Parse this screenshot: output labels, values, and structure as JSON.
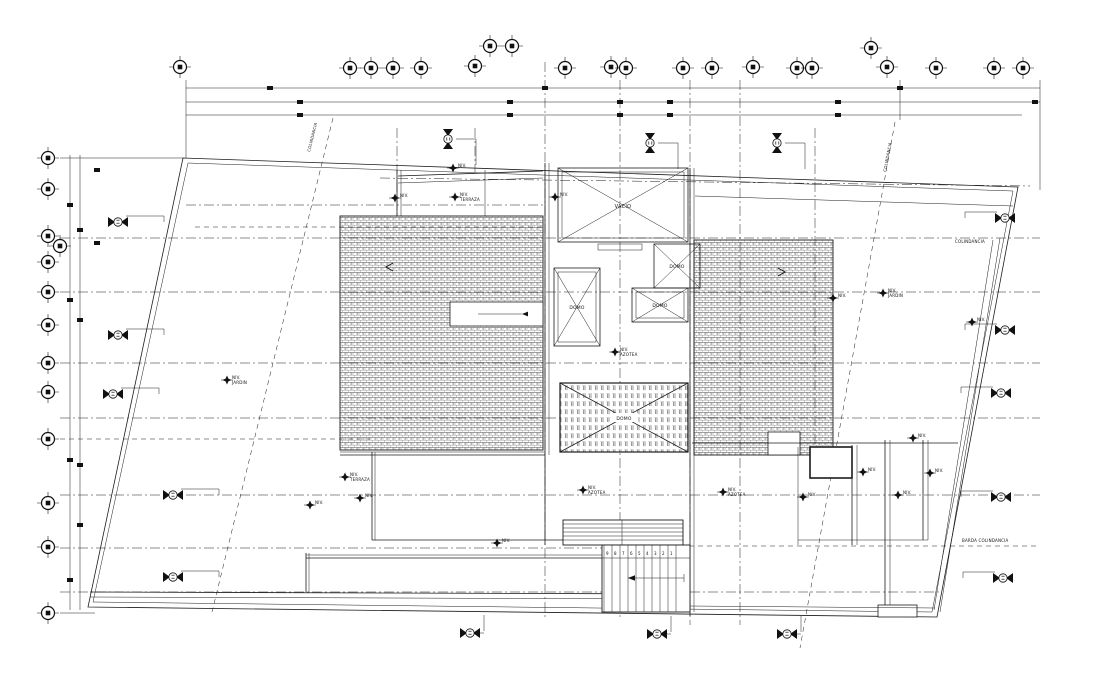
{
  "drawing": {
    "background": "#ffffff",
    "ink": "#1c1c1c",
    "type": "architectural roof plan (CAD)"
  },
  "labels": {
    "niv": "NIV.",
    "vacio": "VACIO",
    "domo": "DOMO",
    "barda_note": "BARDA COLINDANCIA",
    "colindancia_left": "COLINDANCIA",
    "colindancia_right": "COLINDANCIA",
    "corner_note": "COLINDANCIA"
  },
  "levels": [
    {
      "name": "TERRAZA"
    },
    {
      "name": "JARDIN"
    },
    {
      "name": "TERRAZA"
    },
    {
      "name": "AZOTEA"
    },
    {
      "name": "AZOTEA"
    },
    {
      "name": "AZOTEA"
    },
    {
      "name": "JARDIN"
    }
  ],
  "stairs": {
    "numbers": [
      "9",
      "8",
      "7",
      "6",
      "5",
      "4",
      "3",
      "2",
      "1"
    ]
  }
}
